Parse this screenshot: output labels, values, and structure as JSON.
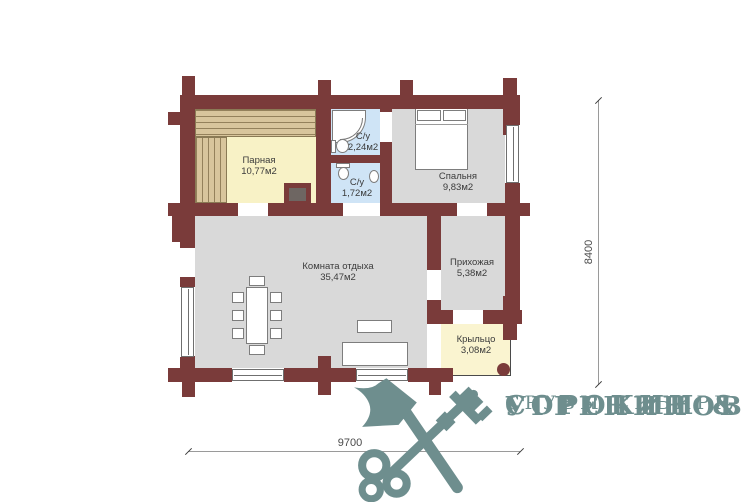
{
  "rooms": [
    {
      "name": "Парная",
      "area": "10,77м2"
    },
    {
      "name": "С/у",
      "area": "2,24м2"
    },
    {
      "name": "С/у",
      "area": "1,72м2"
    },
    {
      "name": "Спальня",
      "area": "9,83м2"
    },
    {
      "name": "Комната отдыха",
      "area": "35,47м2"
    },
    {
      "name": "Прихожая",
      "area": "5,38м2"
    },
    {
      "name": "Крыльцо",
      "area": "3,08м2"
    }
  ],
  "dimensions": {
    "height": "8400",
    "width": "9700"
  },
  "logo": {
    "line1": "СОРОКИН &",
    "line2": "УГРЕНИНОВ",
    "line3": "СРУБЫ СИБИРИ",
    "icon": "crossed-axe-key-icon"
  },
  "colors": {
    "wall": "#7a3b3a",
    "steam_floor": "#f8f2c6",
    "bath_floor": "#cfe4f6",
    "room_floor": "#d9d9d9",
    "porch_floor": "#faf4d0",
    "bench": "#d8c59c",
    "logo": "#6e8e8e"
  }
}
